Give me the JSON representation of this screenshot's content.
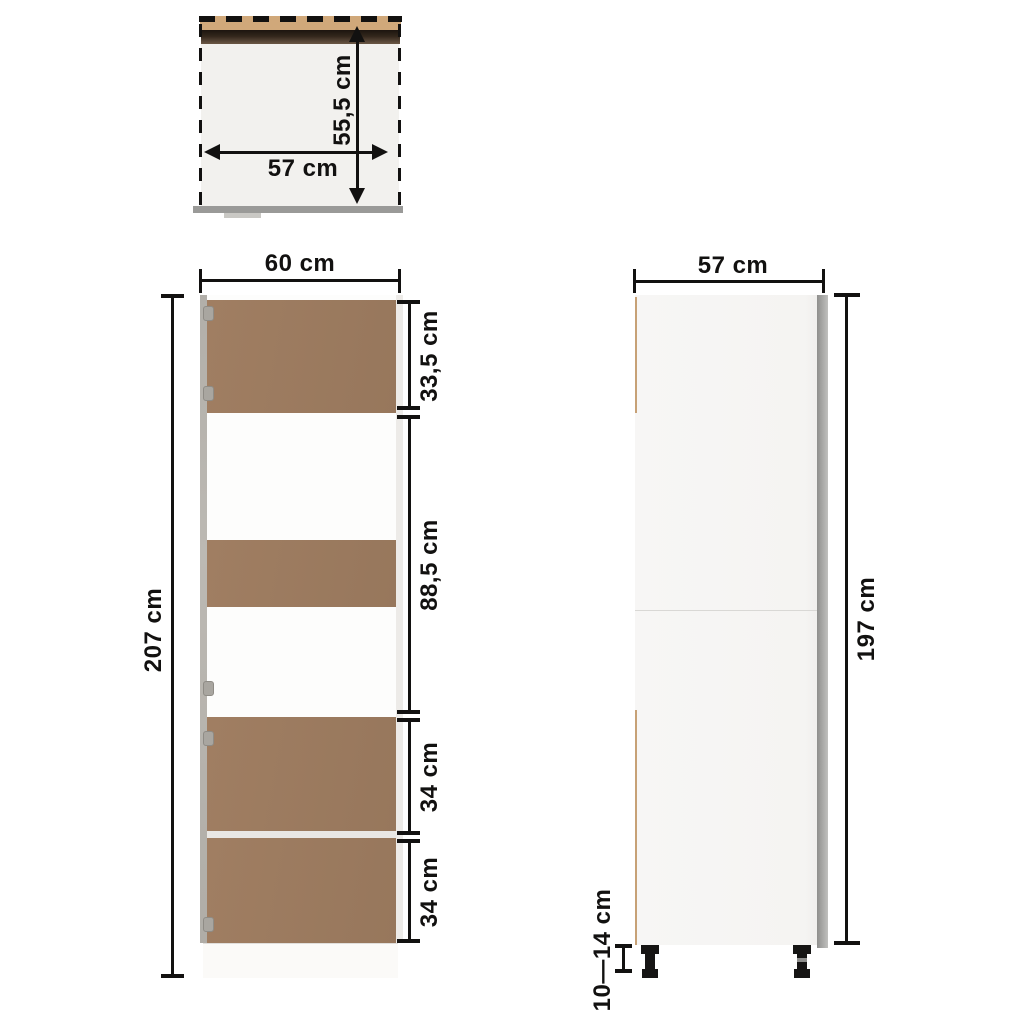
{
  "diagram": {
    "kind": "cabinet-dimension-diagram",
    "views": {
      "top": {
        "width_label": "57 cm",
        "depth_label": "55,5 cm"
      },
      "front": {
        "width_label": "60 cm",
        "height_label": "207 cm",
        "sections": [
          {
            "label": "33,5 cm"
          },
          {
            "label": "88,5 cm"
          },
          {
            "label": "34 cm"
          },
          {
            "label": "34 cm"
          }
        ]
      },
      "side": {
        "width_label": "57 cm",
        "height_label": "197 cm",
        "feet_height_label": "10—14 cm"
      }
    },
    "colors": {
      "door_brown": "#9d7c60",
      "edge_tan": "#d0a87a",
      "top_strip_dark_brown": "#33271c",
      "carcass_gray": "#b5b2ac",
      "base_gray": "#9a9a98",
      "side_panel": "#f6f6f4",
      "dimension_ink": "#121110"
    }
  }
}
